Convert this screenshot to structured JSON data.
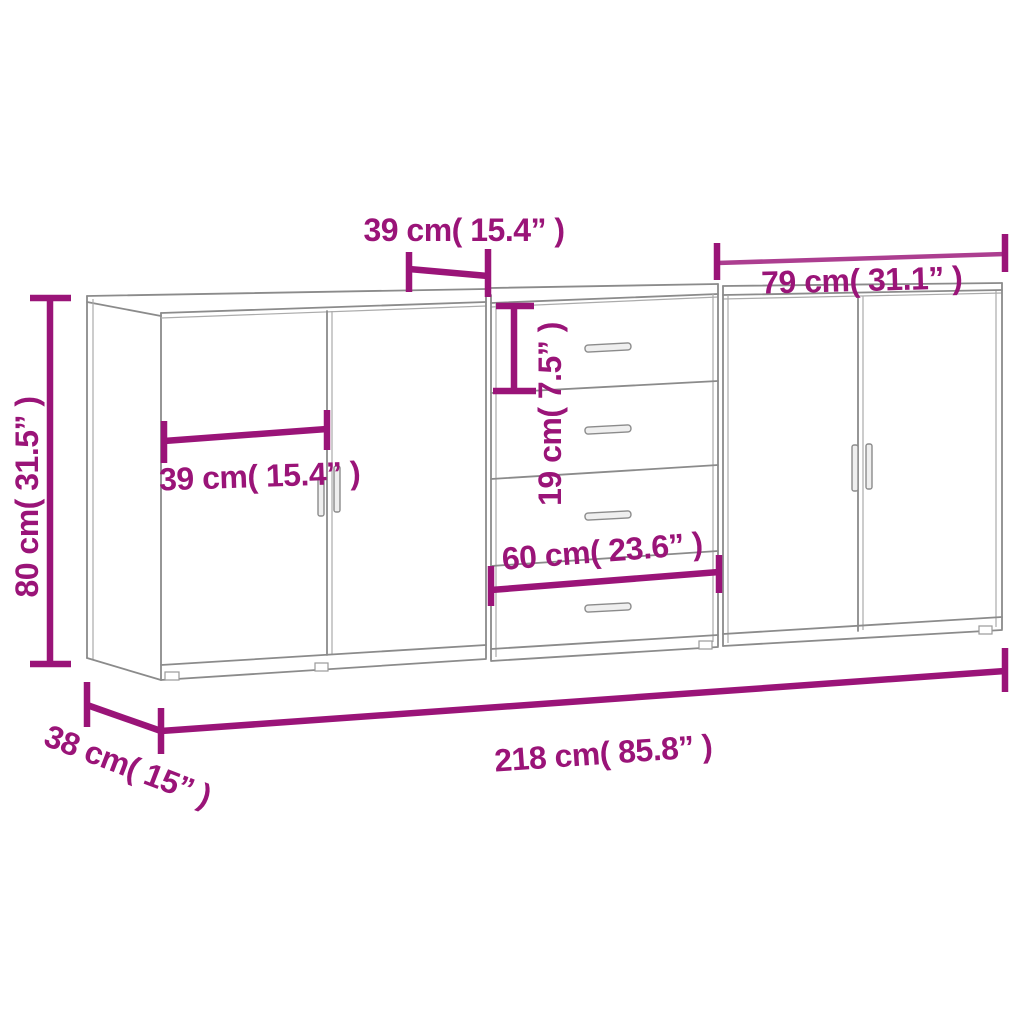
{
  "diagram": {
    "kind": "furniture-dimension-diagram",
    "subject": "three sideboards side by side (two door cabinets and one four-drawer cabinet)",
    "background": "#ffffff"
  },
  "colors": {
    "dimension_annotation": "#9A1478",
    "furniture_outline": "#8b8b8b"
  },
  "labels": {
    "door_width_top": "39 cm( 15.4” )",
    "right_unit_width": "79 cm( 31.1” )",
    "height": "80 cm( 31.5” )",
    "door_width_inner": "39 cm( 15.4” )",
    "drawer_height": "19 cm( 7.5” )",
    "drawer_unit_width": "60 cm( 23.6” )",
    "total_width": "218 cm( 85.8” )",
    "depth": "38 cm( 15” )"
  },
  "measurements": [
    {
      "name": "door width (top bracket)",
      "cm": 39,
      "inches": 15.4
    },
    {
      "name": "right unit width",
      "cm": 79,
      "inches": 31.1
    },
    {
      "name": "height",
      "cm": 80,
      "inches": 31.5
    },
    {
      "name": "door width (inner)",
      "cm": 39,
      "inches": 15.4
    },
    {
      "name": "drawer height",
      "cm": 19,
      "inches": 7.5
    },
    {
      "name": "drawer unit width",
      "cm": 60,
      "inches": 23.6
    },
    {
      "name": "total width",
      "cm": 218,
      "inches": 85.8
    },
    {
      "name": "depth",
      "cm": 38,
      "inches": 15
    }
  ]
}
